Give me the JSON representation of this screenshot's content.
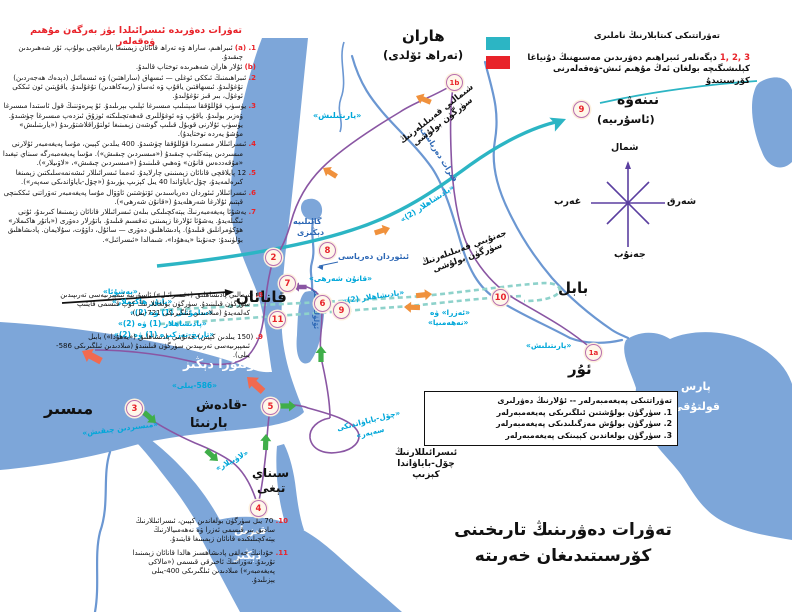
{
  "colors": {
    "water": "#7da6d9",
    "river": "#6b97d2",
    "route": "#8a56a3",
    "teal": "#2cb5c4",
    "tealdash": "#8ed2cb",
    "orange": "#f0913c",
    "green": "#3fae49",
    "redarrow": "#f16a50",
    "cyanlabel": "#00a7d9",
    "bluelabel": "#2e68b5",
    "redtext": "#e8232a",
    "markerring": "#b86fb0",
    "markerfill": "#fff7ea"
  },
  "left_panel": {
    "title": "تەۋرات دەۋرىدە ئىسرائىلدا يۈز بەرگەن مۇھىم ۋەقەلەر",
    "items": [
      {
        "num": "1. (a)",
        "text": "ئىبراھىم، ساراھ ۋە تەراھ قانائان زېمىنىغا بارماقچى بولۇپ، ئۇر شەھىرىدىن چىقىدۇ."
      },
      {
        "num": "(b)",
        "text": "ئۇلار ھاران شەھىرىدە توختاپ قالىدۇ."
      },
      {
        "num": "2.",
        "text": "ئىبراھىمنىڭ ئىككى ئوغلى — ئىسھاق (ساراھتىن) ۋە ئىسمائىل (دېدەك ھەجەردىن) تۇغۇلىدۇ. ئىسھاقتىن ياقۇپ ۋە ئەساۋ (رىبەكاھدىن) تۇغۇلىدۇ. ياقۇپتىن ئون ئىككى ئوغۇل، بىر قىز تۇغۇلىدۇ."
      },
      {
        "num": "3.",
        "text": "يۈسۈپ قۇللۇققا سېتىلىپ مىسىرغا ئېلىپ بېرىلىدۇ. ئۇ پىرەۋننىڭ قول ئاستىدا مىسىرغا ۋەزىر بولىدۇ. ياقۇپ ۋە ئوغۇللىرى قەھەتچىلىكتە ئوزۇق ئىزدەپ مىسىرغا چۈشىدۇ. يۈسۈپ ئۇلارنى قوبۇل قىلىپ گوشەن زېمىنىغا ئولتۇراقلاشتۇرىدۇ («يارىتىلىش» مۇشۇ يەردە توختايدۇ)."
      },
      {
        "num": "4.",
        "text": "ئىسرائىللار مىسىردا قۇللۇققا چۈشىدۇ. 400 يىلدىن كېيىن، مۇسا پەيغەمبەر ئۇلارنى مىسىردىن يېتەكلەپ چىقىدۇ («مىسىردىن چىقىش»). مۇسا پەيغەمبەرگە سىناي تېغىدا «مۇقەددەس قانۇن» ۋەھىي قىلىنىدۇ («مىسىردىن چىقىش»، «لاۋىيلار»)."
      },
      {
        "num": "5.",
        "text": "12 پايلاقچى قانائان زېمىنىنى چارلايدۇ. ئەمما ئىسرائىللار ئىشەنمەسلىكتىن زېمىنغا كىرەلمەيدۇ، چۆل-باياۋاندا 40 يىل كېزىپ يۈرىدۇ («چۆل-باياۋاندىكى سەپەر»)."
      },
      {
        "num": "6.",
        "text": "ئىسرائىللار ئىئوردان دەرياسىدىن ئۆتۈشتىن ئاۋۋال مۇسا پەيغەمبەر تەۋراتنى ئىككىنچى قېتىم ئۇلارغا شەرھلەيدۇ («قانۇن شەرھى»)."
      },
      {
        "num": "7.",
        "text": "يەشۇئا پەيغەمبەرنىڭ يېتەكچىلىكى بىلەن ئىسرائىللار قانائان زېمىنىغا كىرىدۇ، ئۇنى ئىگىلەيدۇ. يەشۇئا ئۇلارغا زېمىننى تەقسىم قىلىدۇ. باتۇرلار دەۋرى («باتۇر ھاكىملار» ھۆكۈمرانلىق قىلىدۇ). پادىشاھلىق دەۋرى — سائۇل، داۋۇت، سۇلايمان. پادىشاھلىق بۆلۈنىدۇ: جەنۇبتا «يەھۇدا»، شىمالدا «ئىسرائىل»."
      }
    ],
    "items_mid": [
      {
        "num": "8.",
        "text": "شىمالىي پادىشاھلىق («ئىسرائىل») ئاسۇرىيە ئىمپېرىيەسى تەرىپىدىن سۈرگۈن قىلىنىدۇ. سۈرگۈن بولغانلارنىڭ كۆپ قىسمى قايتىپ كەلمەيدۇ (مىلادىدىن ئىلگىرىكى 721-يىل)."
      },
      {
        "num": "9.",
        "text": "(150 يىلدىن كېيىن) جەنۇبىي پادىشاھلىق («يەھۇدا») بابىل ئىمپېرىيەسى تەرىپىدىن سۈرگۈن قىلىنىدۇ (مىلادىدىن ئىلگىرىكى 586-يىلى)."
      }
    ],
    "items_bottom": [
      {
        "num": "10.",
        "text": "70 يىل سۈرگۈن بولغاندىن كېيىن، ئىسرائىللارنىڭ سادىق بىر قىسمى ئەزرا ۋە نەھەمىيالارنىڭ يېتەكچىلىكىدە قانائان زېمىنىغا قايتىدۇ."
      },
      {
        "num": "11.",
        "text": "خۇدانىڭ خەلقى پادىشاھسىز ھالدا قانائان زېمىنىدا تۇرىدۇ. تەۋراتنىڭ ئاخىرقى قىسمى («مالاكى پەيغەمبەر») مىلادىدىن ئىلگىرىكى 400-يىلى يېزىلىدۇ."
      }
    ]
  },
  "legend_books": {
    "books_label": "تەۋراتتىكى كىتابلارنىڭ ناملىرى",
    "events_numbers": "1, 2, 3",
    "events_label": "دېگەنلەر ئىبراھىم دەۋرىدىن مەسىھنىڭ دۇنياغا كېلىشىگىچە بولغان ئەڭ مۇھىم ئىش-ۋەقەلەرنى كۆرسىتىدۇ"
  },
  "legend_prophets": {
    "title": "تەۋراتتىكى پەيغەمبەرلەر -- ئۇلارنىڭ دەۋرلىرى",
    "items": [
      "1. سۈرگۈن بولۇشتىن ئىلگىرىكى پەيغەمبەرلەر",
      "2. سۈرگۈن بولۇش مەزگىلىدىكى پەيغەمبەرلەر",
      "3. سۈرگۈن بولغاندىن كېيىنكى پەيغەمبەرلەر"
    ]
  },
  "compass": {
    "north": "شمال",
    "south": "جەنۇب",
    "east": "شەرق",
    "west": "غەرب"
  },
  "map": {
    "places": {
      "haran": "ھاران",
      "haran_sub": "(تەراھ ئۆلدى)",
      "nineveh": "نىنەۋە",
      "nineveh_sub": "(ئاسۇرىيە)",
      "babylon": "بابل",
      "ur": "ئۇر",
      "canaan": "قانائان",
      "egypt": "مىسىر",
      "kadesh_l1": "-قادەش",
      "kadesh_l2": "بارنىئا",
      "sinai_l1": "سىناي",
      "sinai_l2": "تېغى"
    },
    "seas": {
      "mediterranean": "ئوتتۇرا دېڭىز",
      "red_l1": "قىزىل",
      "red_l2": "دېڭىز",
      "persian_l1": "پارس",
      "persian_l2": "قولتۇقى"
    },
    "rivers": {
      "euphrates": "فىرات دەرياسى",
      "jordan": "ئىئوردان دەرياسى",
      "galilee_l1": "گالىلىيە",
      "galilee_l2": "دېڭىزى",
      "dead_sea": "ئۆلۈك دېڭىز"
    },
    "books": {
      "genesis1": "«يارىتىلىش»",
      "genesis2": "«يارىتىلىش»",
      "exodus": "«مىسىردىن چىقىش»",
      "leviticus": "«لاۋىيلار»",
      "numbers_l1": "«چۆل-باياۋاندىكى",
      "numbers_l2": "سەپەر»",
      "deuteronomy": "«قانۇن شەرھى»",
      "joshua": "«يەشۇئا»",
      "judges": "«باتۇر ھاكىملار»",
      "samuel": "«سامۇئىل (1) ۋە (2)»",
      "kings12": "«پادىشاھلار (1) ۋە (2)»",
      "chronicles": "«تارىخ-تەزكىرە (1) ۋە (2)»",
      "kings2a": "«پادىشاھلار (2)»",
      "kings2b": "«پادىشاھلار (2)»",
      "ezra_l1": "«ئەزرا» ۋە",
      "ezra_l2": "«نەھەمىيا»",
      "year586": "«586-يىلى»"
    },
    "notes": {
      "north_l1": "شىمالىي قەبىلىلەرنىڭ",
      "north_l2": "سۈرگۈن بولۇشى",
      "south_l1": "جەنۇبىي قەبىلىلەرنىڭ",
      "south_l2": "سۈرگۈن بولۇشى",
      "wild_l1": "ئىسرائىللارنىڭ",
      "wild_l2": "چۆل-باياۋاندا",
      "wild_l3": "كېزىپ"
    }
  },
  "markers": [
    {
      "label": "1a"
    },
    {
      "label": "1b"
    },
    {
      "label": "2"
    },
    {
      "label": "3"
    },
    {
      "label": "4"
    },
    {
      "label": "5"
    },
    {
      "label": "6"
    },
    {
      "label": "7"
    },
    {
      "label": "8"
    },
    {
      "label": "9"
    },
    {
      "label": "9"
    },
    {
      "label": "10"
    },
    {
      "label": "11"
    }
  ],
  "bottom_title": {
    "line1": "تەۋرات دەۋرىنىڭ تارىخىنى",
    "line2": "كۆرسىتىدىغان خەرىتە"
  }
}
